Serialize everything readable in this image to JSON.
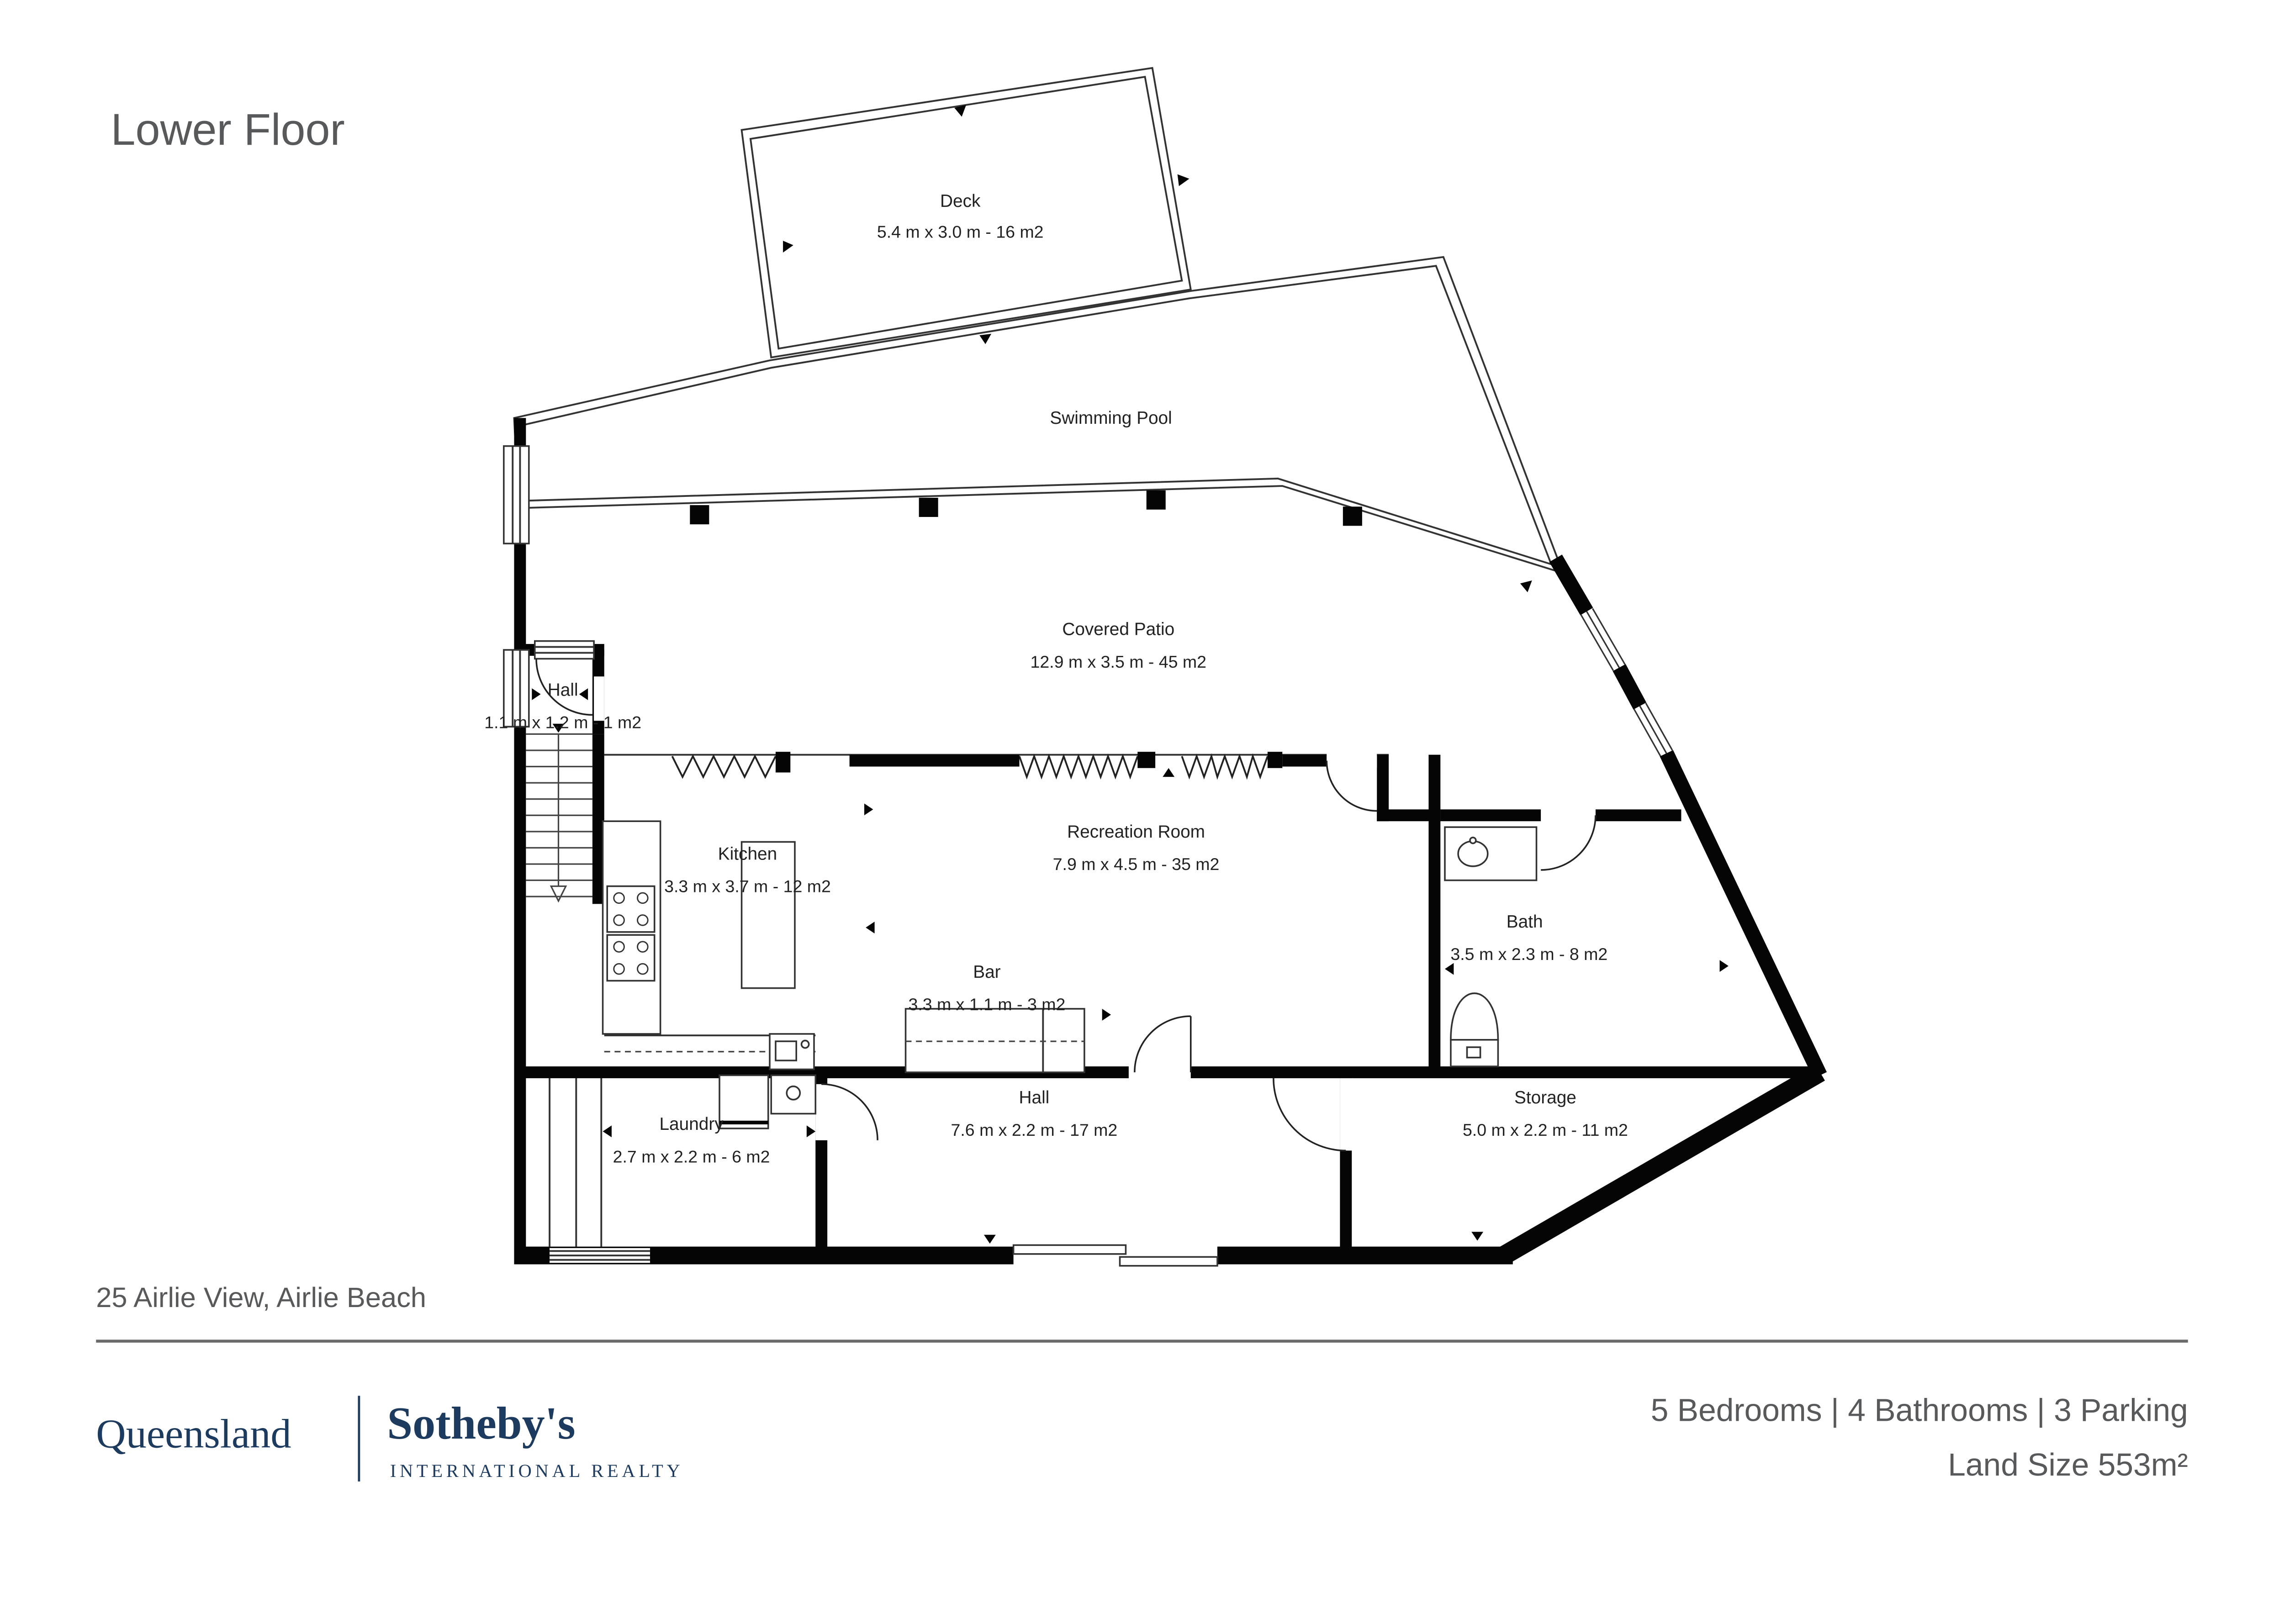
{
  "title": "Lower Floor",
  "address": "25 Airlie View, Airlie Beach",
  "rooms": {
    "deck": {
      "name": "Deck",
      "dims": "5.4 m x 3.0 m - 16 m2"
    },
    "pool": {
      "name": "Swimming Pool"
    },
    "patio": {
      "name": "Covered Patio",
      "dims": "12.9 m x 3.5 m - 45 m2"
    },
    "hall_upper": {
      "name": "Hall",
      "dims": "1.1 m x 1.2 m - 1 m2"
    },
    "kitchen": {
      "name": "Kitchen",
      "dims": "3.3 m x 3.7 m - 12 m2"
    },
    "recreation": {
      "name": "Recreation Room",
      "dims": "7.9 m x 4.5 m - 35 m2"
    },
    "bar": {
      "name": "Bar",
      "dims": "3.3 m x 1.1 m - 3 m2"
    },
    "bath": {
      "name": "Bath",
      "dims": "3.5 m x 2.3 m - 8 m2"
    },
    "laundry": {
      "name": "Laundry",
      "dims": "2.7 m x 2.2 m - 6 m2"
    },
    "hall_lower": {
      "name": "Hall",
      "dims": "7.6 m x 2.2 m - 17 m2"
    },
    "storage": {
      "name": "Storage",
      "dims": "5.0 m x 2.2 m - 11 m2"
    }
  },
  "footer": {
    "brand_region": "Queensland",
    "brand_name": "Sotheby's",
    "brand_sub": "INTERNATIONAL REALTY",
    "stats_line": "5 Bedrooms | 4 Bathrooms | 3 Parking",
    "land_size": "Land Size 553m²"
  },
  "colors": {
    "text_gray": "#58595b",
    "brand_navy": "#1d3a5f",
    "wall_black": "#050505"
  }
}
